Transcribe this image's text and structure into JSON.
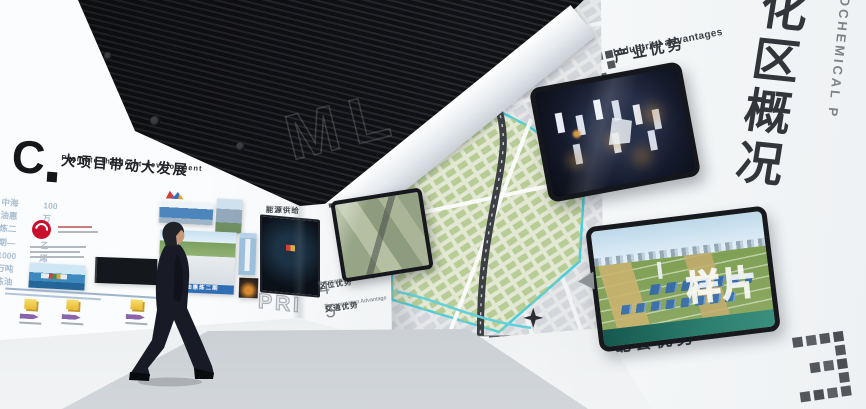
{
  "scene": {
    "description": "Petrochemical industrial park exhibition hall interior render"
  },
  "right_wall": {
    "vertical_title_cn": "化区概况",
    "vertical_title_en": "OCHEMICAL P"
  },
  "advantage_labels": {
    "industrial": {
      "digit": "2",
      "title_cn": "产业优势",
      "title_en": "Industrial advantages"
    },
    "complementary": {
      "digit": "3",
      "title_cn": "配套优势",
      "title_en": "Complementary advantages"
    },
    "service": {
      "digit": "1",
      "title_cn": "服务优势",
      "title_en": "service advantage"
    },
    "location": {
      "digit": "4",
      "title_cn": "区位优势",
      "title_en": "Geographical advantages"
    },
    "transportation": {
      "digit": "5",
      "title_cn": "交通优势",
      "title_en": "Transportation Advantage"
    }
  },
  "left_wall": {
    "logo_text": "C",
    "headline_cn": "大项目带动大发展",
    "headline_chevron": "»",
    "headline_en": "Promote the great development",
    "subline_1": "中海油惠炼二期—1000万吨炼油",
    "subline_2": "100万吨乙烯",
    "photo_caption": "中海油惠炼二期"
  },
  "mid_wall": {
    "screen_title_cn": "能源供给",
    "screen_title_en": "energy supply",
    "pixel_letters": "PRI"
  },
  "watermarks": {
    "sample": "样片",
    "ceiling": "ML"
  },
  "palette": {
    "ceiling_dark": "#1a1b1f",
    "map_boundary_cyan": "#49cfdc",
    "cnooc_red": "#c8102e",
    "timeline_yellow": "#f2c63c",
    "timeline_purple": "#8a63ad",
    "suit_navy": "#171a24"
  }
}
